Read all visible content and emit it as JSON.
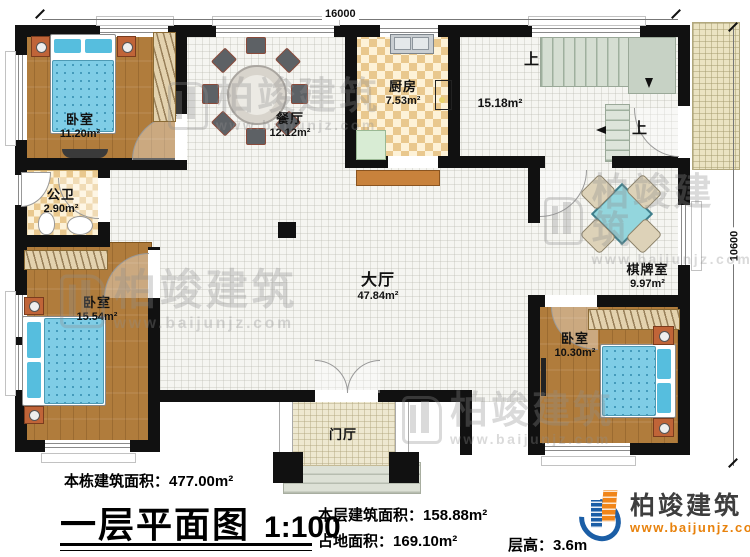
{
  "dimensions": {
    "top": "16000",
    "right": "10600"
  },
  "rooms": {
    "bedroom1": {
      "name": "卧室",
      "area": "11.20m²"
    },
    "dining": {
      "name": "餐厅",
      "area": "12.12m²"
    },
    "kitchen": {
      "name": "厨房",
      "area": "7.53m²"
    },
    "stair_hall": {
      "area": "15.18m²"
    },
    "bathroom": {
      "name": "公卫",
      "area": "2.90m²"
    },
    "bedroom2": {
      "name": "卧室",
      "area": "15.54m²"
    },
    "hall": {
      "name": "大厅",
      "area": "47.84m²"
    },
    "chess": {
      "name": "棋牌室",
      "area": "9.97m²"
    },
    "bedroom3": {
      "name": "卧室",
      "area": "10.30m²"
    },
    "foyer": {
      "name": "门厅"
    }
  },
  "stairs": {
    "up1": "上",
    "up2": "上"
  },
  "watermark": {
    "text": "柏竣建筑",
    "url": "www.baijunjz.com"
  },
  "footer": {
    "building_area_label": "本栋建筑面积：",
    "building_area_value": "477.00m²",
    "plan_title": "一层平面图",
    "scale": "1:100",
    "floor_area_label": "本层建筑面积：",
    "floor_area_value": "158.88m²",
    "footprint_label": "占地面积：",
    "footprint_value": "169.10m²",
    "floor_height_label": "层高：",
    "floor_height_value": "3.6m"
  },
  "logo": {
    "name": "柏竣建筑",
    "url": "www.baijunjz.com"
  },
  "colors": {
    "wall": "#111111",
    "wood": "#b07c3c",
    "bed_blue": "#7fcde6",
    "logo_blue": "#1b5ea6",
    "logo_orange": "#e8820c"
  }
}
